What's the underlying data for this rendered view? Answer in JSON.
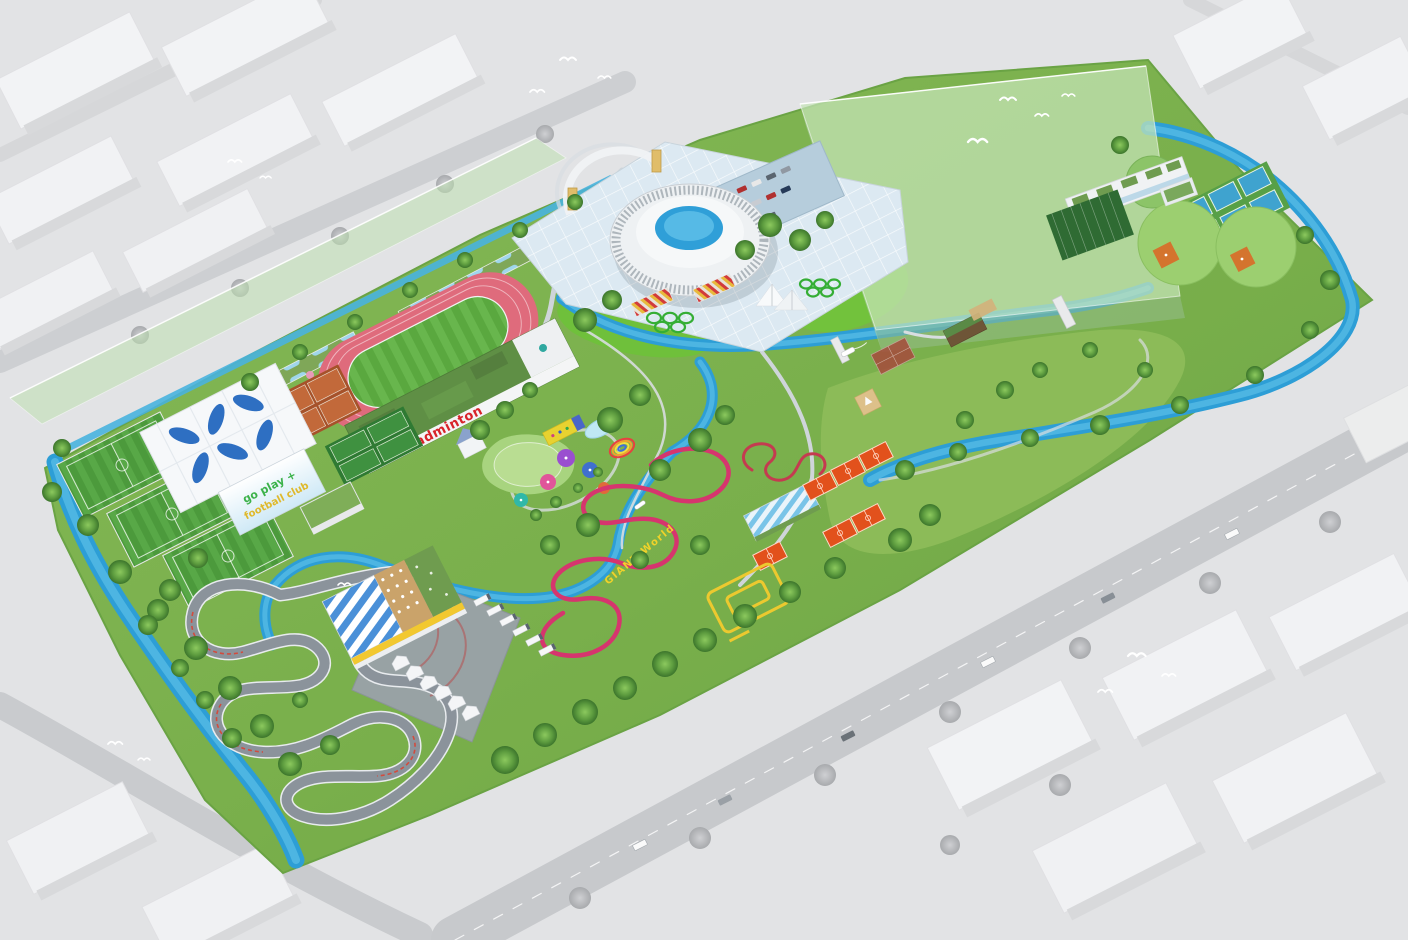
{
  "scene": {
    "description": "Aerial bird's-eye master-plan rendering of a riverside sports park; surrounding city shown as desaturated grey massing with white birds flying over",
    "labels": {
      "badminton_hall": "badminton",
      "football_club_line1": "go play +",
      "football_club_line2": "football club",
      "bike_park": "GIANT World"
    },
    "colors": {
      "context_grey": "#e4e5e7",
      "context_block_white": "#f2f3f5",
      "site_green": "#7cb34c",
      "water_blue": "#2d9ed6",
      "athletics_track_pink": "#df6b7c",
      "clay_court_orange": "#b5582c",
      "tennis_court_blue": "#3fa3cf",
      "basketball_orange": "#e2511c",
      "bike_track_magenta": "#d6356e",
      "accent_yellow": "#ecc92f",
      "arena_white": "#eef1f3",
      "arena_pool_blue": "#2f9fd8",
      "future_volume_green": "#b8ddb0",
      "canopy_blue": "#2e6fc2",
      "kart_asphalt_grey": "#8b939b",
      "badminton_text_red": "#d8232a",
      "olympic_rings_green": "#35ae35"
    },
    "features": [
      "central-arena",
      "entrance-arch-gate",
      "visitor-parking",
      "event-plaza",
      "athletics-track",
      "badminton-hall",
      "football-club-pitches",
      "tensile-canopy",
      "football-club-banner",
      "clay-tennis-courts",
      "green-courts",
      "children-playground",
      "mushroom-umbrellas",
      "giant-world-bike-track",
      "pump-track",
      "basketball-courts",
      "traffic-training-lines",
      "go-kart-circuit",
      "kart-clubhouse",
      "service-tents",
      "truck-parking",
      "practice-pad",
      "baseball-fields",
      "tennis-courts",
      "driving-range",
      "indoor-sports-hall",
      "riverside-pavilion",
      "sand-play-pit",
      "olympic-rings-topiary",
      "sail-canopy",
      "future-development-volume",
      "future-development-strip",
      "river-canal",
      "bridges",
      "boats",
      "cherry-blossom-row",
      "gallery-colonnade",
      "city-context-blocks",
      "city-roads",
      "birds"
    ]
  }
}
